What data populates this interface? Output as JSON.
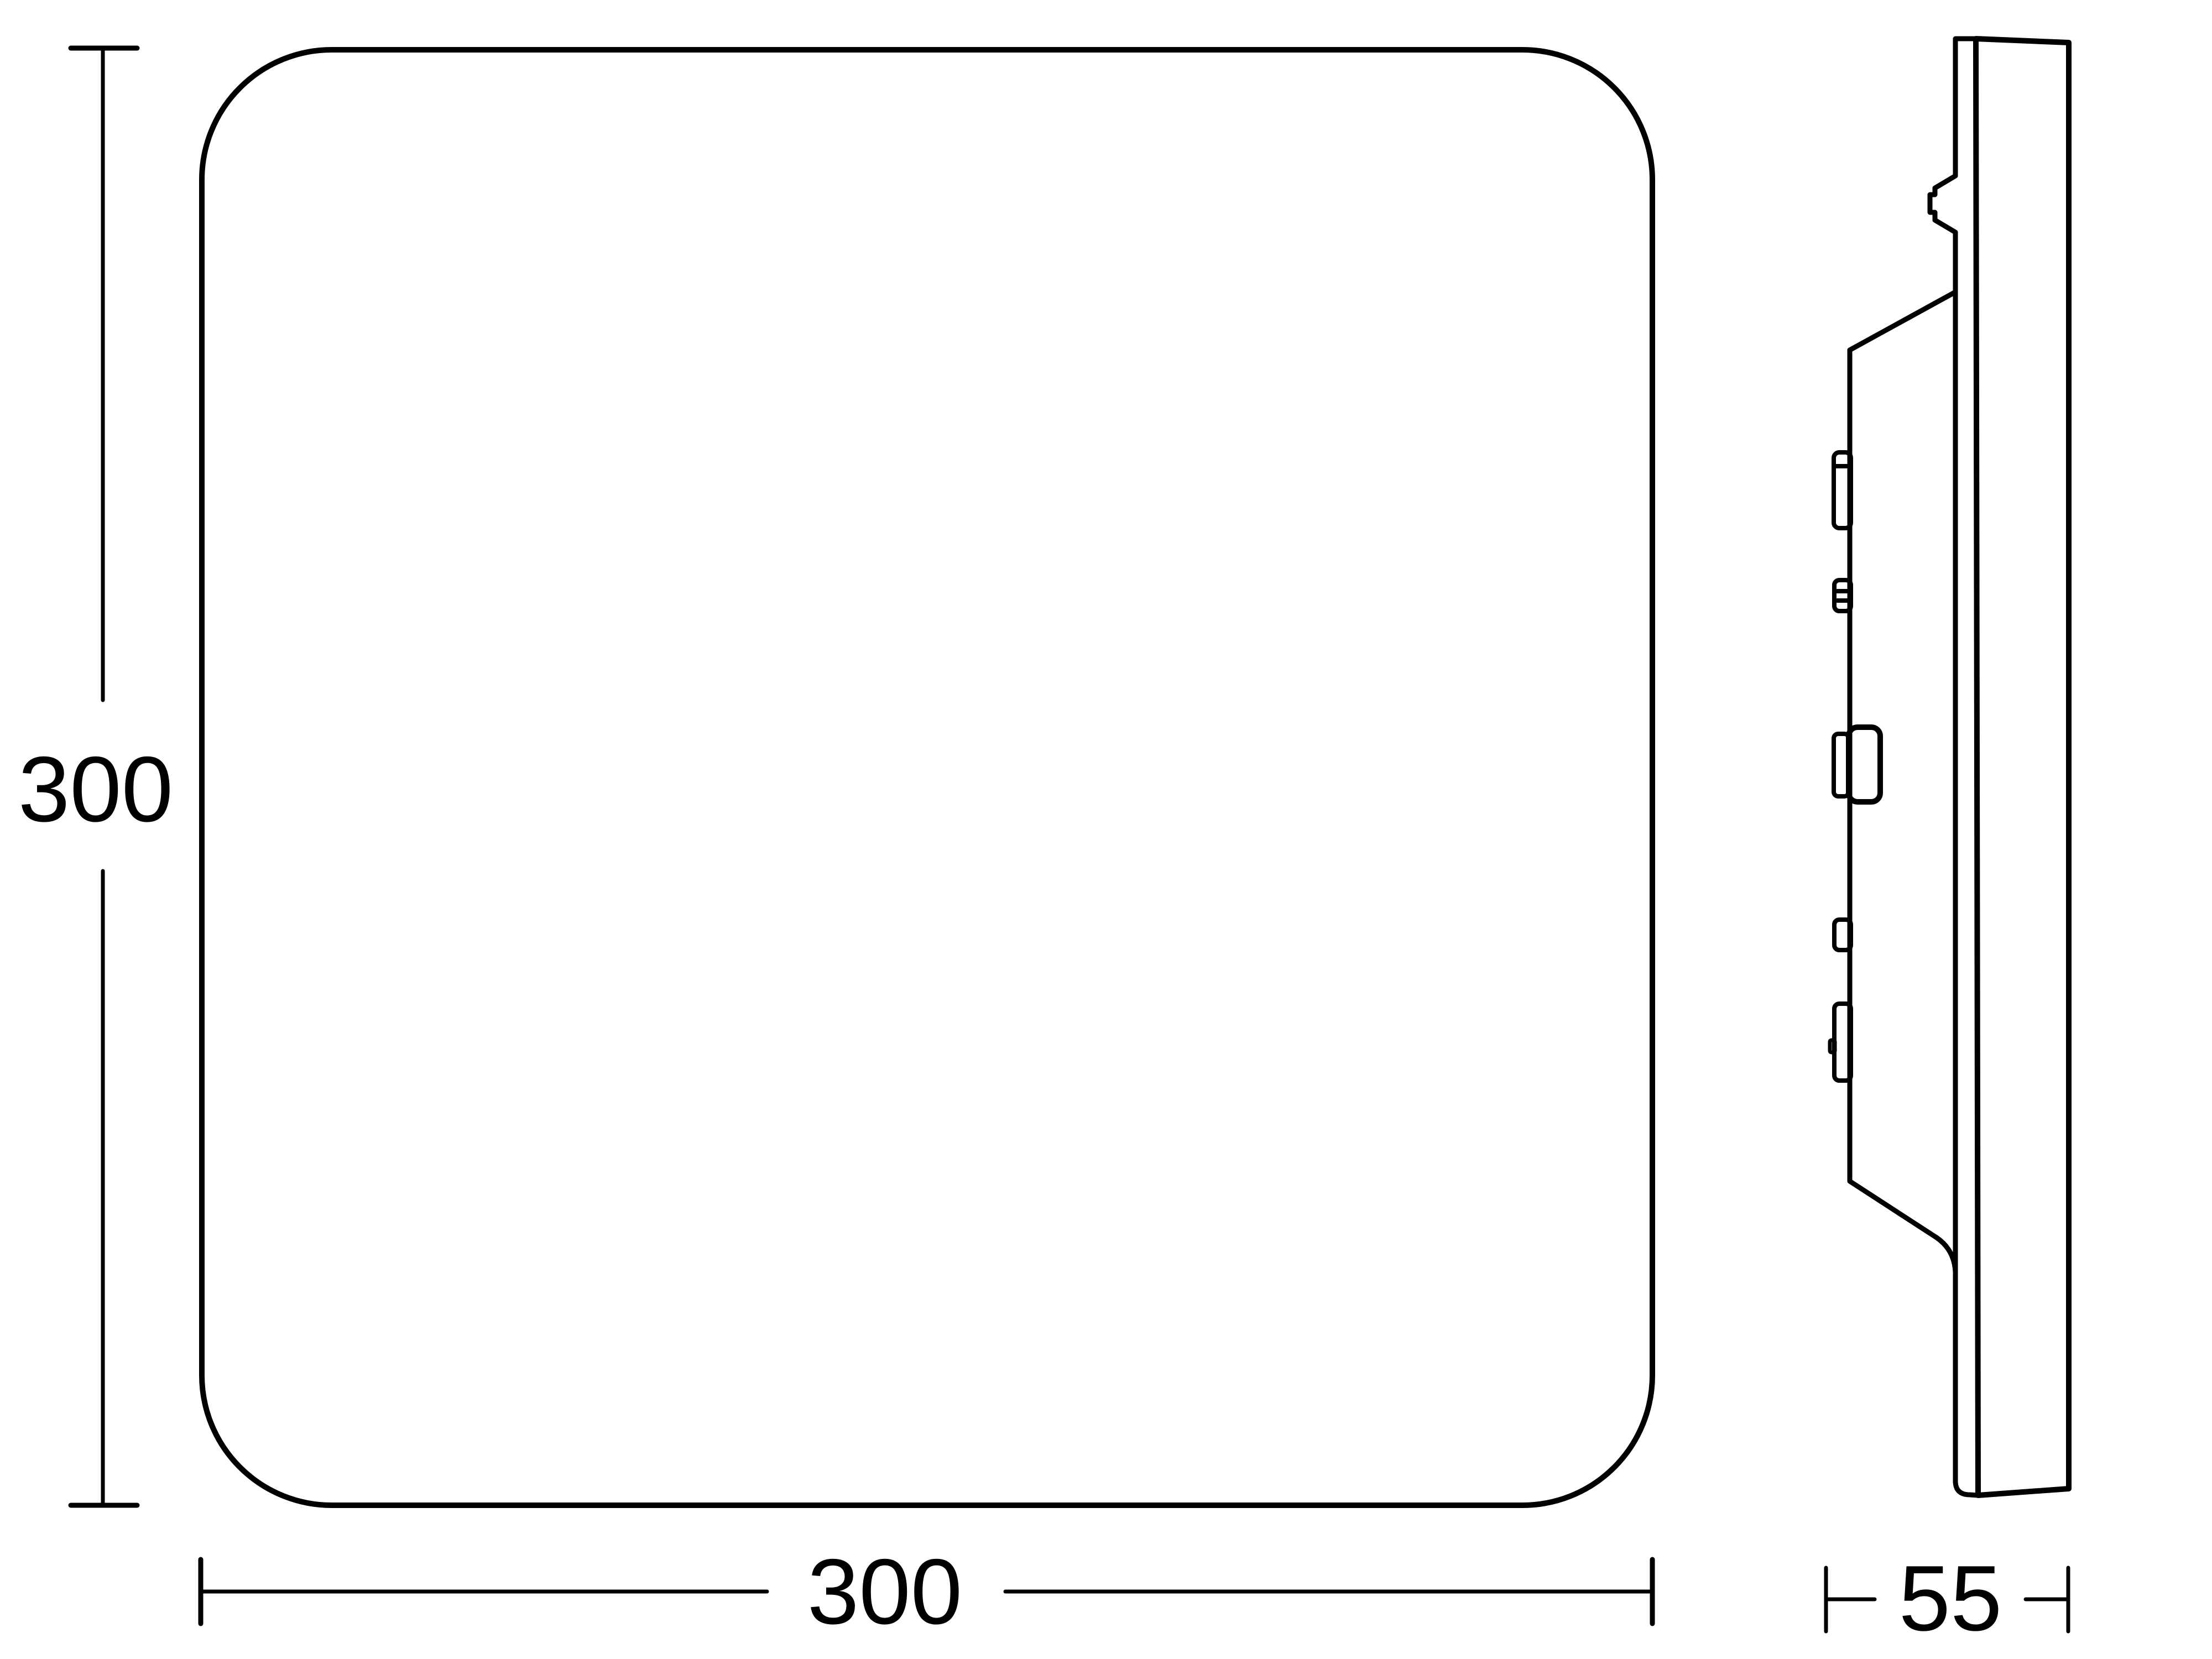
{
  "drawing": {
    "front_view": {
      "height_label": "300",
      "width_label": "300"
    },
    "side_view": {
      "depth_label": "55"
    },
    "colors": {
      "line": "#000000",
      "background": "#ffffff"
    }
  }
}
